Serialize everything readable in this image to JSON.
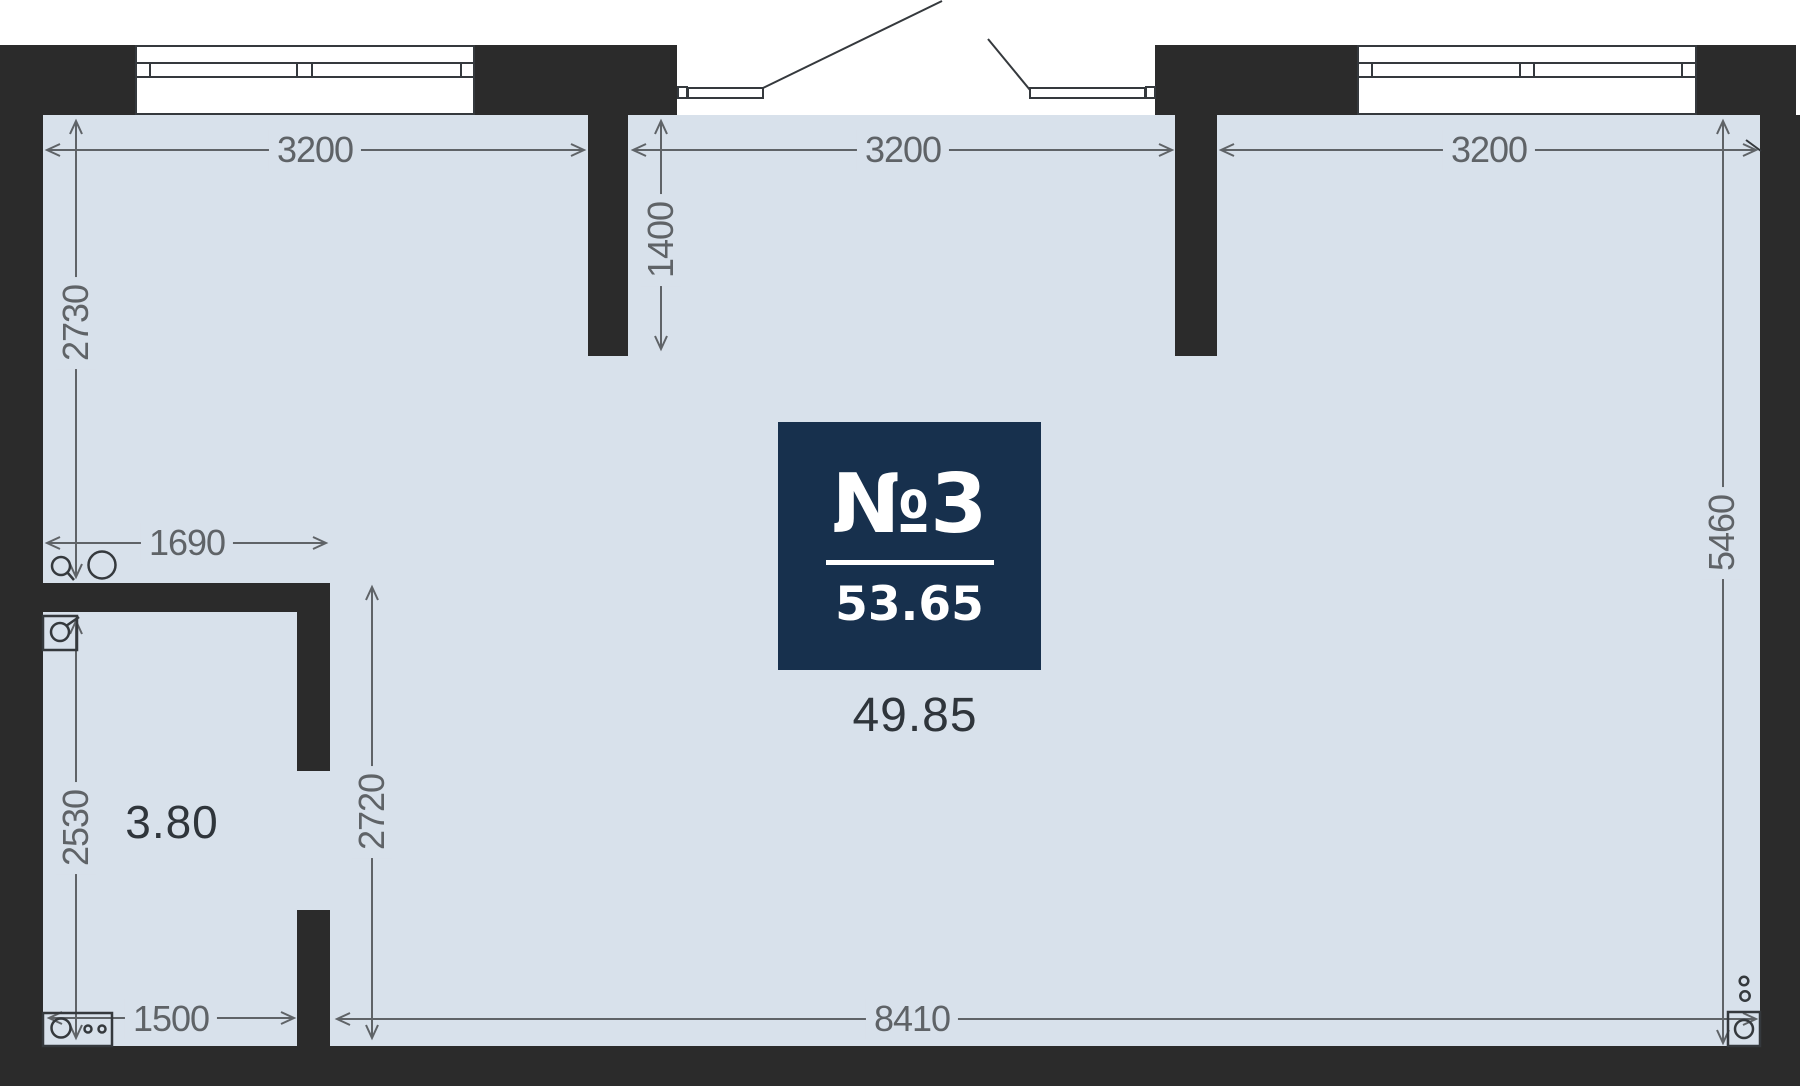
{
  "unit": {
    "number": "№3",
    "total_area": "53.65",
    "main_room_area": "49.85",
    "bathroom_area": "3.80"
  },
  "dimensions": {
    "top_left": "3200",
    "top_middle": "3200",
    "top_right": "3200",
    "stub_depth": "1400",
    "left_upper": "2730",
    "bathroom_width": "1690",
    "left_lower": "2530",
    "room_height": "2720",
    "bottom_left": "1500",
    "bottom_main": "8410",
    "right_side": "5460"
  },
  "fixtures": {
    "sink_small": "sink-small-circle",
    "sink_large": "sink-large-circle",
    "water_heater": "water-heater-icon",
    "washing_machine": "washing-machine-icon",
    "electric_meter": "electric-meter-icon"
  },
  "colors": {
    "wall": "#2b2b2b",
    "floor": "#d8e1eb",
    "badge": "#17304d",
    "dimension": "#5f6367",
    "area_text": "#2f353b"
  }
}
